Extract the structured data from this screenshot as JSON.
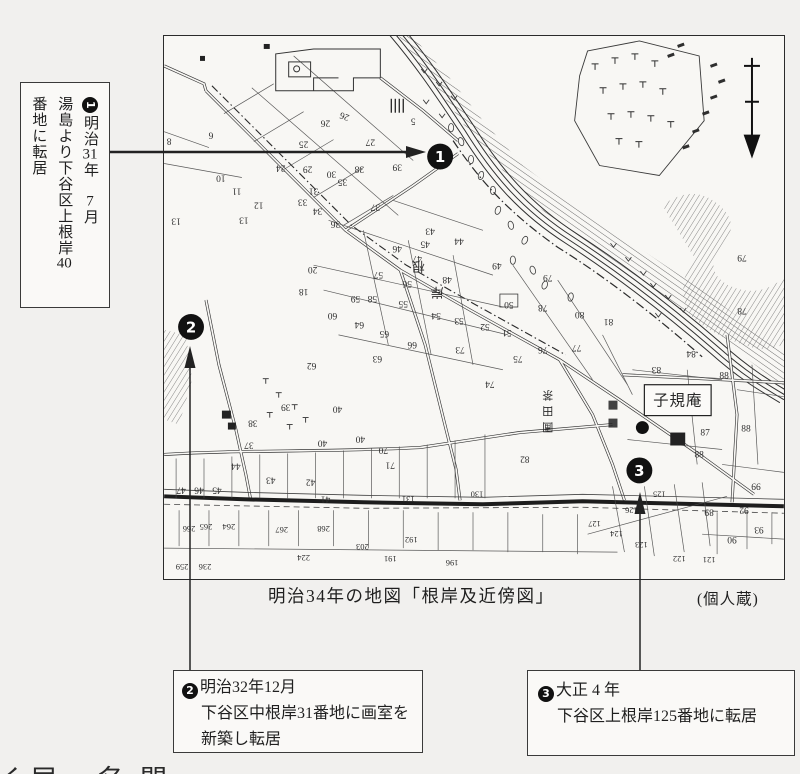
{
  "annotations": {
    "note1": {
      "lines": [
        [
          {
            "t": "1",
            "badge": true
          },
          {
            "t": "明治"
          },
          {
            "t": "31",
            "tcy": true
          },
          {
            "t": "年　"
          },
          {
            "t": "7",
            "tcy": true
          },
          {
            "t": "月"
          }
        ],
        [
          {
            "t": "湯島より下谷区上根岸"
          },
          {
            "t": "40",
            "tcy": true
          }
        ],
        [
          {
            "t": "番地に転居"
          }
        ]
      ]
    },
    "note2": {
      "badge": "2",
      "line1": "明治32年12月",
      "line2": "下谷区中根岸31番地に画室を",
      "line3": "新築し転居"
    },
    "note3": {
      "badge": "3",
      "line1": "大正 4 年",
      "line2": "下谷区上根岸125番地に転居"
    }
  },
  "caption": {
    "title": "明治34年の地図「根岸及近傍図」",
    "credit": "(個人蔵)"
  },
  "map": {
    "shikian_label": "子規庵",
    "markers": [
      {
        "label": "1",
        "x": 277,
        "y": 121
      },
      {
        "label": "2",
        "x": 27,
        "y": 292
      },
      {
        "label": "3",
        "x": 477,
        "y": 436
      }
    ],
    "labels": [
      {
        "t": "根",
        "x": 255,
        "y": 227,
        "r": 180,
        "s": 13
      },
      {
        "t": "岸",
        "x": 274,
        "y": 253,
        "r": 180,
        "s": 13
      },
      {
        "t": "茶",
        "x": 385,
        "y": 357,
        "r": 180,
        "s": 11
      },
      {
        "t": "田",
        "x": 385,
        "y": 373,
        "r": 180,
        "s": 11
      },
      {
        "t": "圃",
        "x": 385,
        "y": 389,
        "r": 180,
        "s": 11
      }
    ],
    "parcels": [
      {
        "n": "6",
        "x": 47,
        "y": 97,
        "r": 180
      },
      {
        "n": "8",
        "x": 5,
        "y": 103,
        "r": 180
      },
      {
        "n": "10",
        "x": 57,
        "y": 140,
        "r": 180
      },
      {
        "n": "11",
        "x": 73,
        "y": 153,
        "r": 180
      },
      {
        "n": "12",
        "x": 95,
        "y": 167,
        "r": 180
      },
      {
        "n": "13",
        "x": 80,
        "y": 182,
        "r": 180
      },
      {
        "n": "13",
        "x": 12,
        "y": 183,
        "r": 180
      },
      {
        "n": "24",
        "x": 117,
        "y": 130,
        "r": 180
      },
      {
        "n": "25",
        "x": 140,
        "y": 106,
        "r": 180
      },
      {
        "n": "26",
        "x": 162,
        "y": 85,
        "r": 180
      },
      {
        "n": "26",
        "x": 182,
        "y": 78,
        "r": 200
      },
      {
        "n": "27",
        "x": 207,
        "y": 104,
        "r": 180
      },
      {
        "n": "29",
        "x": 144,
        "y": 131,
        "r": 180
      },
      {
        "n": "30",
        "x": 168,
        "y": 136,
        "r": 180
      },
      {
        "n": "31",
        "x": 150,
        "y": 153,
        "r": 180
      },
      {
        "n": "33",
        "x": 139,
        "y": 164,
        "r": 180
      },
      {
        "n": "34",
        "x": 154,
        "y": 173,
        "r": 180
      },
      {
        "n": "35",
        "x": 179,
        "y": 144,
        "r": 180
      },
      {
        "n": "36",
        "x": 172,
        "y": 186,
        "r": 180
      },
      {
        "n": "37",
        "x": 212,
        "y": 169,
        "r": 180
      },
      {
        "n": "38",
        "x": 196,
        "y": 131,
        "r": 180
      },
      {
        "n": "39",
        "x": 234,
        "y": 129,
        "r": 180
      },
      {
        "n": "5",
        "x": 250,
        "y": 83,
        "r": 180
      },
      {
        "n": "43",
        "x": 267,
        "y": 193,
        "r": 180
      },
      {
        "n": "45",
        "x": 262,
        "y": 206,
        "r": 180
      },
      {
        "n": "44",
        "x": 296,
        "y": 203,
        "r": 180
      },
      {
        "n": "46",
        "x": 234,
        "y": 211,
        "r": 180
      },
      {
        "n": "47",
        "x": 254,
        "y": 221,
        "r": 180
      },
      {
        "n": "49",
        "x": 334,
        "y": 228,
        "r": 180
      },
      {
        "n": "48",
        "x": 284,
        "y": 242,
        "r": 180
      },
      {
        "n": "56",
        "x": 244,
        "y": 246,
        "r": 180
      },
      {
        "n": "57",
        "x": 215,
        "y": 237,
        "r": 180
      },
      {
        "n": "20",
        "x": 149,
        "y": 232,
        "r": 180
      },
      {
        "n": "18",
        "x": 140,
        "y": 254,
        "r": 180
      },
      {
        "n": "58",
        "x": 209,
        "y": 261,
        "r": 180
      },
      {
        "n": "59",
        "x": 192,
        "y": 261,
        "r": 180
      },
      {
        "n": "55",
        "x": 240,
        "y": 266,
        "r": 180
      },
      {
        "n": "54",
        "x": 273,
        "y": 278,
        "r": 180
      },
      {
        "n": "53",
        "x": 296,
        "y": 283,
        "r": 180
      },
      {
        "n": "52",
        "x": 322,
        "y": 289,
        "r": 180
      },
      {
        "n": "51",
        "x": 344,
        "y": 295,
        "r": 180
      },
      {
        "n": "50",
        "x": 346,
        "y": 267,
        "r": 180
      },
      {
        "n": "60",
        "x": 169,
        "y": 278,
        "r": 180
      },
      {
        "n": "64",
        "x": 196,
        "y": 287,
        "r": 180
      },
      {
        "n": "65",
        "x": 221,
        "y": 296,
        "r": 180
      },
      {
        "n": "66",
        "x": 249,
        "y": 307,
        "r": 180
      },
      {
        "n": "63",
        "x": 214,
        "y": 321,
        "r": 180
      },
      {
        "n": "62",
        "x": 148,
        "y": 328,
        "r": 180
      },
      {
        "n": "73",
        "x": 297,
        "y": 312,
        "r": 180
      },
      {
        "n": "75",
        "x": 355,
        "y": 321,
        "r": 180
      },
      {
        "n": "76",
        "x": 380,
        "y": 312,
        "r": 180
      },
      {
        "n": "78",
        "x": 380,
        "y": 270,
        "r": 180
      },
      {
        "n": "79",
        "x": 385,
        "y": 240,
        "r": 180
      },
      {
        "n": "80",
        "x": 417,
        "y": 277,
        "r": 180
      },
      {
        "n": "81",
        "x": 446,
        "y": 284,
        "r": 180
      },
      {
        "n": "77",
        "x": 414,
        "y": 310,
        "r": 180
      },
      {
        "n": "74",
        "x": 327,
        "y": 347,
        "r": 180
      },
      {
        "n": "79",
        "x": 580,
        "y": 220,
        "r": 180
      },
      {
        "n": "78",
        "x": 580,
        "y": 273,
        "r": 180
      },
      {
        "n": "83",
        "x": 494,
        "y": 332,
        "r": 180
      },
      {
        "n": "84",
        "x": 529,
        "y": 316,
        "r": 180
      },
      {
        "n": "82",
        "x": 362,
        "y": 422,
        "r": 180
      },
      {
        "n": "88",
        "x": 562,
        "y": 344,
        "r": 0
      },
      {
        "n": "88",
        "x": 584,
        "y": 397,
        "r": 0
      },
      {
        "n": "87",
        "x": 543,
        "y": 401,
        "r": 0
      },
      {
        "n": "88",
        "x": 537,
        "y": 423,
        "r": 0
      },
      {
        "n": "39",
        "x": 122,
        "y": 370,
        "r": 180
      },
      {
        "n": "38",
        "x": 89,
        "y": 386,
        "r": 180
      },
      {
        "n": "40",
        "x": 174,
        "y": 372,
        "r": 180
      },
      {
        "n": "40",
        "x": 159,
        "y": 406,
        "r": 180
      },
      {
        "n": "40",
        "x": 197,
        "y": 402,
        "r": 180
      },
      {
        "n": "37",
        "x": 85,
        "y": 408,
        "r": 180
      },
      {
        "n": "44",
        "x": 72,
        "y": 429,
        "r": 180
      },
      {
        "n": "43",
        "x": 107,
        "y": 443,
        "r": 180
      },
      {
        "n": "42",
        "x": 147,
        "y": 445,
        "r": 180
      },
      {
        "n": "41",
        "x": 162,
        "y": 462,
        "r": 180
      },
      {
        "n": "47",
        "x": 17,
        "y": 453,
        "r": 180
      },
      {
        "n": "46",
        "x": 35,
        "y": 453,
        "r": 180
      },
      {
        "n": "45",
        "x": 53,
        "y": 453,
        "r": 180
      },
      {
        "n": "70",
        "x": 220,
        "y": 413,
        "r": 180
      },
      {
        "n": "71",
        "x": 227,
        "y": 428,
        "r": 180
      },
      {
        "n": "131",
        "x": 245,
        "y": 462,
        "r": 180
      },
      {
        "n": "130",
        "x": 314,
        "y": 457,
        "r": 180
      },
      {
        "n": "265",
        "x": 42,
        "y": 490,
        "r": 180
      },
      {
        "n": "264",
        "x": 65,
        "y": 490,
        "r": 180
      },
      {
        "n": "266",
        "x": 25,
        "y": 492,
        "r": 180
      },
      {
        "n": "267",
        "x": 118,
        "y": 493,
        "r": 180
      },
      {
        "n": "268",
        "x": 160,
        "y": 492,
        "r": 180
      },
      {
        "n": "224",
        "x": 140,
        "y": 521,
        "r": 180
      },
      {
        "n": "203",
        "x": 199,
        "y": 510,
        "r": 180
      },
      {
        "n": "191",
        "x": 227,
        "y": 522,
        "r": 180
      },
      {
        "n": "192",
        "x": 248,
        "y": 503,
        "r": 180
      },
      {
        "n": "196",
        "x": 289,
        "y": 526,
        "r": 180
      },
      {
        "n": "259",
        "x": 18,
        "y": 530,
        "r": 180
      },
      {
        "n": "236",
        "x": 41,
        "y": 530,
        "r": 180
      },
      {
        "n": "125",
        "x": 497,
        "y": 457,
        "r": 180
      },
      {
        "n": "126",
        "x": 469,
        "y": 473,
        "r": 180
      },
      {
        "n": "124",
        "x": 454,
        "y": 497,
        "r": 180
      },
      {
        "n": "123",
        "x": 479,
        "y": 508,
        "r": 180
      },
      {
        "n": "122",
        "x": 517,
        "y": 522,
        "r": 180
      },
      {
        "n": "121",
        "x": 547,
        "y": 523,
        "r": 180
      },
      {
        "n": "127",
        "x": 432,
        "y": 487,
        "r": 180
      },
      {
        "n": "89",
        "x": 547,
        "y": 475,
        "r": 180
      },
      {
        "n": "92",
        "x": 582,
        "y": 473,
        "r": 180
      },
      {
        "n": "93",
        "x": 597,
        "y": 493,
        "r": 180
      },
      {
        "n": "90",
        "x": 570,
        "y": 503,
        "r": 180
      },
      {
        "n": "99",
        "x": 594,
        "y": 449,
        "r": 180
      }
    ]
  },
  "fragments": [
    {
      "t": "く",
      "x": -2
    },
    {
      "t": "居",
      "x": 30
    },
    {
      "t": "名",
      "x": 97
    },
    {
      "t": "間",
      "x": 140
    }
  ]
}
